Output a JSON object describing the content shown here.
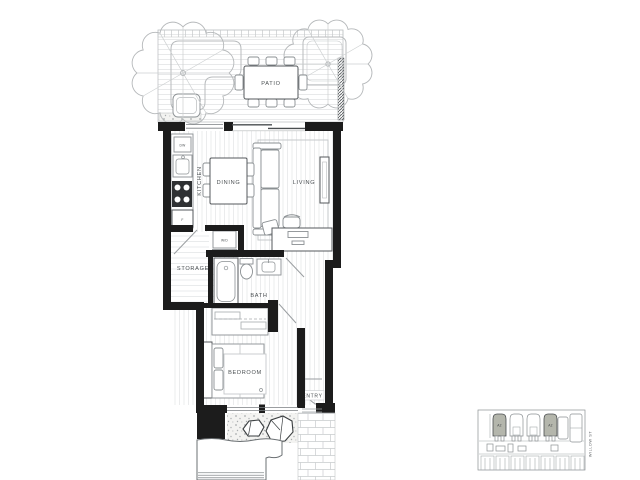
{
  "floorplan": {
    "patio": {
      "label": "PATIO"
    },
    "kitchen": {
      "label": "KITCHEN",
      "dishwasher_label": "DW",
      "fridge_label": "F"
    },
    "dining": {
      "label": "DINING"
    },
    "living": {
      "label": "LIVING"
    },
    "storage": {
      "label": "STORAGE"
    },
    "laundry": {
      "label": "W/D"
    },
    "bath": {
      "label": "BATH"
    },
    "bedroom": {
      "label": "BEDROOM"
    },
    "entry": {
      "label": "ENTRY"
    }
  },
  "keyplan": {
    "units": [
      {
        "label": "A2"
      },
      {
        "label": "A2"
      }
    ],
    "street_label": "WILLOW ST",
    "highlight_color": "#b4b6ac"
  },
  "colors": {
    "wall": "#1c1c1c",
    "line_dark": "#55595c",
    "line_medium": "#8b9093",
    "line_light": "#c6c9cb",
    "floor_line": "#e4e6e7",
    "label_text": "#4a4f52",
    "background": "#ffffff"
  }
}
